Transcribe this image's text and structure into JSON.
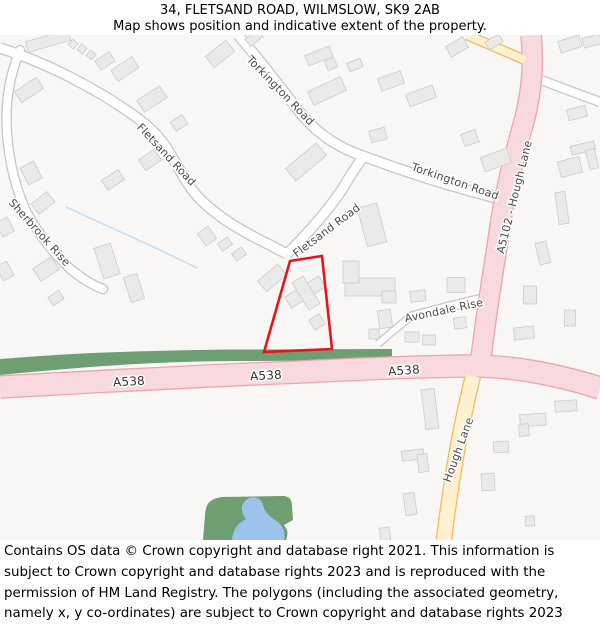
{
  "header": {
    "title": "34, FLETSAND ROAD, WILMSLOW, SK9 2AB",
    "subtitle": "Map shows position and indicative extent of the property."
  },
  "footer": {
    "text": "Contains OS data © Crown copyright and database right 2021. This information is subject to Crown copyright and database rights 2023 and is reproduced with the permission of HM Land Registry. The polygons (including the associated geometry, namely x, y co-ordinates) are subject to Crown copyright and database rights 2023 Ordnance Survey 100026316."
  },
  "map": {
    "colors": {
      "bg": "#f8f7f5",
      "building": "#eaeae8",
      "building_stroke": "#cccbc9",
      "minor_casing": "#c8c7c5",
      "pink": "#f8d9de",
      "pink_casing": "#e9a6b0",
      "yellow": "#fdf1d0",
      "yellow_casing": "#efbd60",
      "green": "#6f9e72",
      "pond": "#9cc3ec",
      "stream": "#bcdcf5",
      "label": "#4a4a4a",
      "a_label": "#333333",
      "property_red": "#e8141c"
    },
    "roads": [
      {
        "name": "fletsand-road-nw",
        "class": "minor",
        "width": 9,
        "path": "M0,13 C 45,27 100,55 140,85 C 168,106 172,125 190,152 C 208,178 245,198 270,210 L287,219"
      },
      {
        "name": "fletsand-road-ne",
        "class": "minor",
        "width": 9,
        "path": "M287,219 C 310,196 335,168 349,143 C 357,130 361,126 363,121"
      },
      {
        "name": "torkington-road-n",
        "class": "minor",
        "width": 9,
        "path": "M238,0 C 252,16 275,45 298,75 C 318,101 342,114 363,121"
      },
      {
        "name": "torkington-road-e",
        "class": "minor",
        "width": 9,
        "path": "M363,121 C 398,134 440,148 478,158 C 492,162 504,165 514,169"
      },
      {
        "name": "sherbrook-rise",
        "class": "minor",
        "width": 8,
        "cap": "round",
        "path": "M20,15 C 9,42 5,68 7,98 C 9,126 15,152 26,176 C 37,198 58,224 74,237 C 84,245 95,251 103,254"
      },
      {
        "name": "minor-road-topright",
        "class": "minor",
        "width": 8,
        "path": "M534,42 C 556,51 578,59 600,67"
      },
      {
        "name": "avondale-rise",
        "class": "minor",
        "width": 8,
        "cap": "round",
        "path": "M481,264 C 458,269 432,276 410,282"
      },
      {
        "name": "avondale-rise-stub",
        "class": "minor",
        "width": 6,
        "path": "M410,282 C 398,292 388,300 378,309"
      },
      {
        "name": "a5102-hough-lane",
        "class": "pink",
        "width": 19,
        "path": "M531,0 C 534,28 532,58 523,90 C 513,125 504,162 499,198 C 494,232 489,262 485,292 C 483,308 481,320 480,331"
      },
      {
        "name": "a538",
        "class": "pink",
        "width": 21,
        "path": "M0,352 C 90,347 200,341 300,337 C 360,334 430,331 478,331 C 520,332 562,341 600,353"
      },
      {
        "name": "hough-lane-south",
        "class": "yellow",
        "width": 14,
        "path": "M473,341 C 467,365 459,402 453,440 C 449,466 446,487 444,505"
      },
      {
        "name": "yellow-road-stub",
        "class": "yellow",
        "width": 8,
        "path": "M525,25 L467,0"
      }
    ],
    "labels": [
      {
        "text": "Fletsand Road",
        "x": 166,
        "y": 120,
        "r": 47,
        "size": 11
      },
      {
        "text": "Torkington Road",
        "x": 280,
        "y": 56,
        "r": 46,
        "size": 11
      },
      {
        "text": "Torkington Road",
        "x": 455,
        "y": 147,
        "r": 19,
        "size": 11
      },
      {
        "text": "Fletsand Road",
        "x": 327,
        "y": 196,
        "r": -37,
        "size": 11
      },
      {
        "text": "Sherbrook Rise",
        "x": 39,
        "y": 198,
        "r": 48,
        "size": 11
      },
      {
        "text": "A5102 - Hough Lane",
        "x": 515,
        "y": 162,
        "r": -76,
        "size": 11
      },
      {
        "text": "Avondale Rise",
        "x": 444,
        "y": 276,
        "r": -12,
        "size": 11
      },
      {
        "text": "Hough Lane",
        "x": 459,
        "y": 415,
        "r": -70,
        "size": 11
      },
      {
        "text": "A538",
        "x": 129,
        "y": 347,
        "r": -3,
        "size": 12,
        "a": true
      },
      {
        "text": "A538",
        "x": 266,
        "y": 341,
        "r": -3,
        "size": 12,
        "a": true
      },
      {
        "text": "A538",
        "x": 404,
        "y": 336,
        "r": -4,
        "size": 12,
        "a": true
      }
    ],
    "areas": {
      "green_strip": "M0,324 C 40,321 80,318 120,317 C 165,315.5 210,314.5 250,314.5 L392,314 L392,325 L250,326 C 210,326 165,327 120,330 C 80,332.5 40,336 0,340 Z",
      "park": "M203,505 L205,480 C 206,468 210,464 222,462 L282,461 C 290,461 292,465 292,471 L293,485 L284,490 L287,495 C 288,499 287,502 286,505 Z",
      "pond": "M232,505 C 233,494 238,488 246,484 C 241,478 240,470 246,465 C 252,460 261,462 263,470 C 264,476 268,480 275,485 C 283,490 286,497 284,505 Z",
      "stream": "M66,172 L160,215 L197,233"
    },
    "property_polygon": {
      "path": "M290,226 L322,221 L332,314 L264,317 Z"
    },
    "buildings": [
      [
        48,
        6,
        44,
        11,
        -16
      ],
      [
        73,
        9,
        7,
        7,
        40
      ],
      [
        82,
        14,
        7,
        7,
        40
      ],
      [
        91,
        20,
        7,
        7,
        40
      ],
      [
        105,
        26,
        17,
        11,
        -33
      ],
      [
        125,
        34,
        25,
        13,
        -33
      ],
      [
        152,
        64,
        27,
        14,
        -33
      ],
      [
        179,
        88,
        14,
        11,
        -33
      ],
      [
        220,
        19,
        26,
        14,
        -38
      ],
      [
        254,
        3,
        16,
        9,
        -38
      ],
      [
        29,
        55,
        26,
        13,
        -33
      ],
      [
        31,
        138,
        15,
        19,
        -28
      ],
      [
        43,
        168,
        20,
        13,
        -38
      ],
      [
        5,
        192,
        13,
        16,
        -28
      ],
      [
        5,
        236,
        12,
        16,
        -28
      ],
      [
        46,
        234,
        22,
        15,
        -33
      ],
      [
        56,
        263,
        13,
        10,
        -33
      ],
      [
        107,
        226,
        17,
        32,
        -18
      ],
      [
        134,
        253,
        14,
        26,
        -18
      ],
      [
        150,
        125,
        19,
        13,
        -33
      ],
      [
        113,
        145,
        20,
        12,
        -33
      ],
      [
        319,
        21,
        26,
        11,
        -22
      ],
      [
        331,
        29,
        10,
        10,
        -22
      ],
      [
        355,
        30,
        14,
        9,
        -22
      ],
      [
        391,
        46,
        24,
        13,
        -20
      ],
      [
        421,
        61,
        28,
        13,
        -20
      ],
      [
        457,
        12,
        20,
        12,
        -30
      ],
      [
        494,
        7,
        16,
        9,
        -30
      ],
      [
        570,
        9,
        22,
        12,
        -18
      ],
      [
        592,
        6,
        18,
        10,
        -15
      ],
      [
        470,
        103,
        15,
        13,
        -20
      ],
      [
        496,
        125,
        28,
        15,
        -20
      ],
      [
        306,
        127,
        40,
        16,
        -40
      ],
      [
        327,
        56,
        36,
        15,
        -25
      ],
      [
        378,
        100,
        16,
        12,
        -15
      ],
      [
        372,
        190,
        20,
        40,
        -15
      ],
      [
        370,
        252,
        50,
        18,
        0
      ],
      [
        351,
        237,
        16,
        22,
        0
      ],
      [
        385,
        284,
        13,
        18,
        -8
      ],
      [
        374,
        299,
        10,
        10,
        0
      ],
      [
        272,
        243,
        26,
        14,
        -40
      ],
      [
        305,
        257,
        40,
        13,
        -32
      ],
      [
        306,
        258,
        13,
        32,
        -32
      ],
      [
        317,
        287,
        12,
        12,
        -32
      ],
      [
        225,
        209,
        12,
        9,
        -35
      ],
      [
        239,
        219,
        12,
        9,
        -35
      ],
      [
        207,
        201,
        13,
        15,
        -35
      ],
      [
        577,
        78,
        19,
        11,
        -14
      ],
      [
        570,
        132,
        22,
        16,
        -14
      ],
      [
        562,
        173,
        10,
        32,
        -8
      ],
      [
        543,
        218,
        11,
        22,
        -14
      ],
      [
        583,
        113,
        24,
        9,
        -14
      ],
      [
        592,
        124,
        9,
        20,
        -14
      ],
      [
        456,
        250,
        18,
        15,
        0
      ],
      [
        418,
        261,
        15,
        11,
        -6
      ],
      [
        389,
        262,
        14,
        12,
        0
      ],
      [
        460,
        288,
        12,
        11,
        -8
      ],
      [
        412,
        302,
        14,
        10,
        0
      ],
      [
        429,
        305,
        13,
        10,
        0
      ],
      [
        530,
        260,
        13,
        18,
        0
      ],
      [
        524,
        298,
        20,
        12,
        -6
      ],
      [
        570,
        283,
        11,
        16,
        0
      ],
      [
        430,
        374,
        13,
        40,
        -7
      ],
      [
        413,
        420,
        22,
        10,
        -7
      ],
      [
        423,
        428,
        10,
        18,
        -7
      ],
      [
        410,
        469,
        11,
        22,
        -8
      ],
      [
        533,
        385,
        26,
        12,
        -4
      ],
      [
        524,
        395,
        10,
        12,
        -4
      ],
      [
        566,
        371,
        22,
        11,
        -4
      ],
      [
        501,
        412,
        15,
        11,
        -4
      ],
      [
        488,
        447,
        13,
        17,
        -4
      ],
      [
        530,
        486,
        9,
        10,
        -4
      ],
      [
        385,
        499,
        10,
        13,
        -8
      ]
    ]
  }
}
